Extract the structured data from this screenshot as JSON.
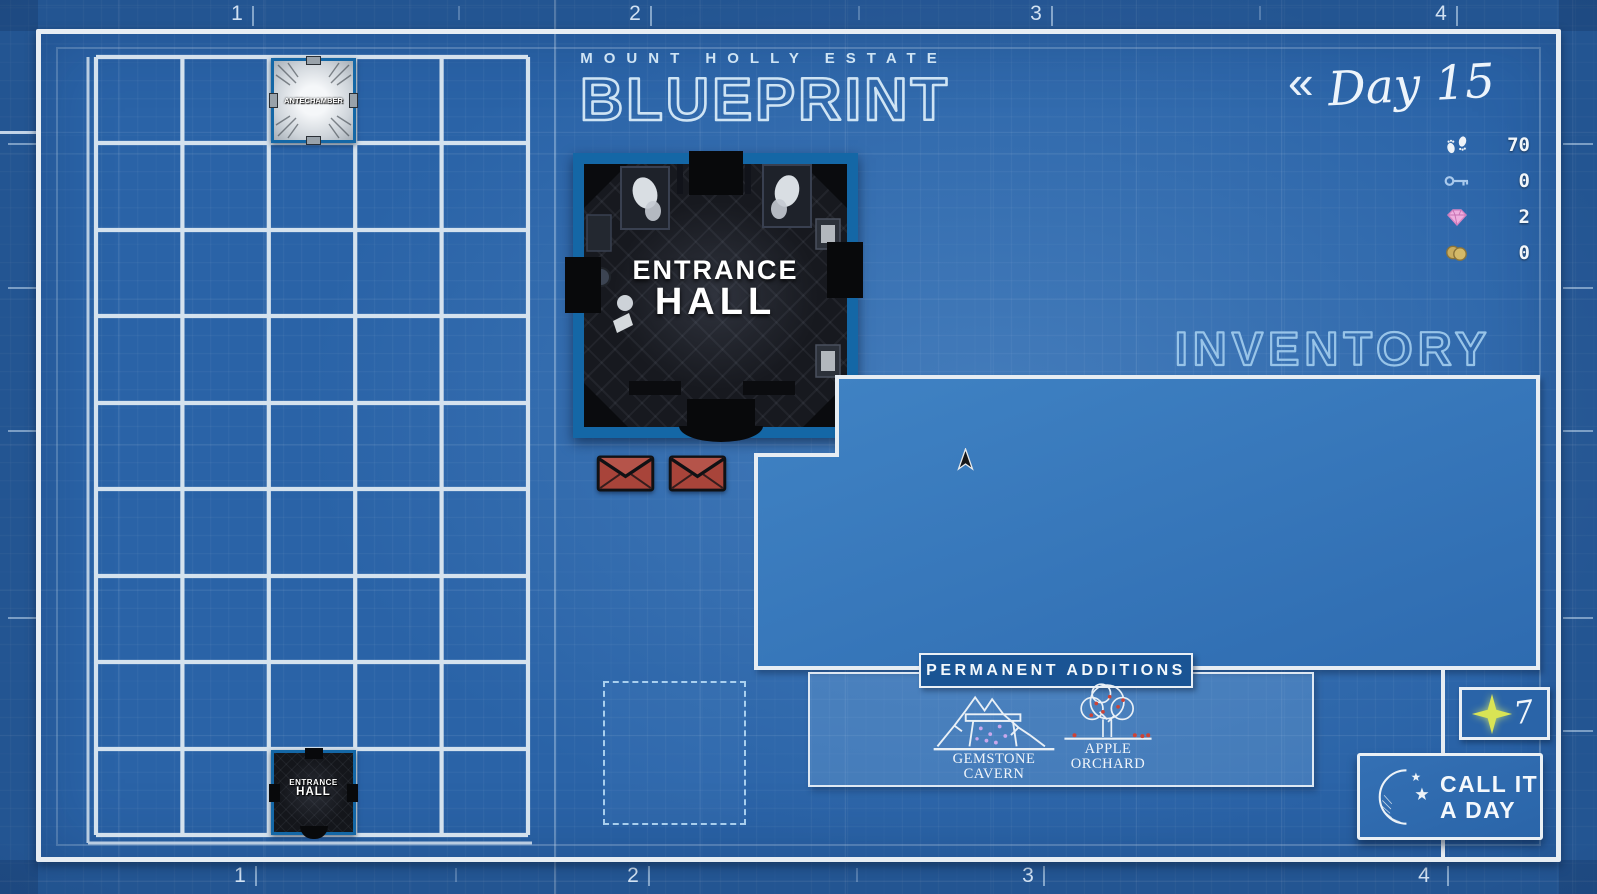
{
  "header": {
    "estate": "MOUNT HOLLY ESTATE",
    "title": "BLUEPRINT"
  },
  "day": {
    "back_symbol": "«",
    "label": "Day 15"
  },
  "resources": {
    "steps": "70",
    "keys": "0",
    "gems": "2",
    "coins": "0"
  },
  "inventory": {
    "title": "INVENTORY"
  },
  "ruler": {
    "top": [
      "1",
      "2",
      "3",
      "4"
    ],
    "bottom": [
      "1",
      "2",
      "3",
      "4"
    ]
  },
  "map_rooms": {
    "antechamber": {
      "label": "ANTECHAMBER"
    },
    "entrance_hall_small": {
      "line1": "ENTRANCE",
      "line2": "HALL"
    }
  },
  "room_preview": {
    "line1": "ENTRANCE",
    "line2": "HALL"
  },
  "permanent_additions": {
    "title": "PERMANENT ADDITIONS",
    "items": [
      {
        "line1": "GEMSTONE",
        "line2": "CAVERN"
      },
      {
        "line1": "APPLE",
        "line2": "ORCHARD"
      }
    ]
  },
  "spirit_counter": {
    "value": "7"
  },
  "end_day_button": {
    "line1": "CALL IT",
    "line2": "A DAY"
  },
  "colors": {
    "background": "#2a63a7",
    "frame": "#e7edf3",
    "room_border": "#1467a6",
    "accent_star": "#d9e455",
    "envelope": "#a8443a",
    "gem": "#eeaede",
    "coin": "#c9ad5f",
    "key": "#a9c9ec"
  }
}
